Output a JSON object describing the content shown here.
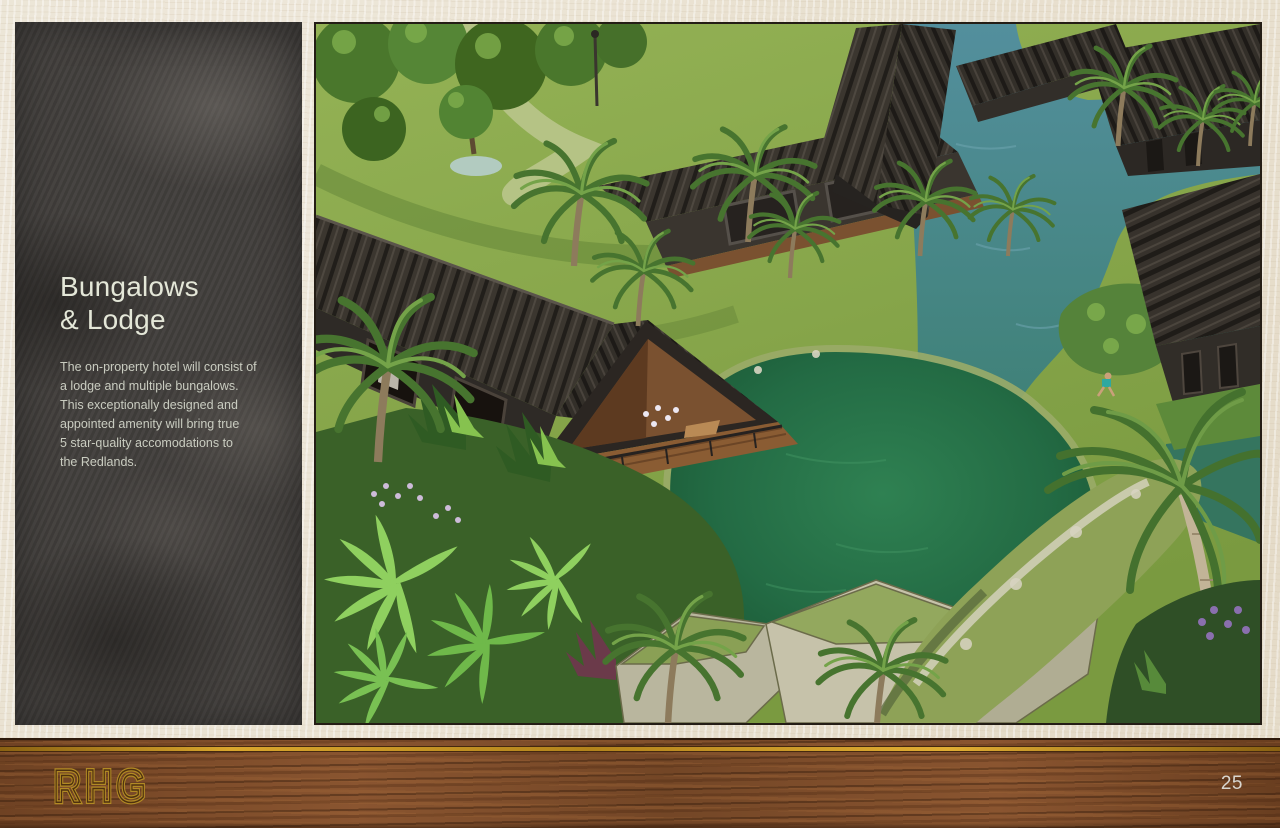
{
  "sidebar": {
    "title_lines": [
      "Bungalows",
      "& Lodge"
    ],
    "body_lines": [
      "The on-property hotel will consist of",
      "a lodge and multiple bungalows.",
      "This exceptionally designed and",
      "appointed amenity will bring true",
      "5 star-quality accomodations to",
      "the Redlands."
    ]
  },
  "image": {
    "description": "Aerial 3D rendering of dark-roofed bungalows and a lodge set among palm trees, a teal waterway, mossy rocks and an emerald lagoon"
  },
  "footer": {
    "logo": "RHG",
    "page_number": "25"
  },
  "colors": {
    "background": "#e9e1d0",
    "panel": "#43403d",
    "title_text": "#e4e7d8",
    "body_text": "#c9ccc0",
    "wood_bar": "#7b4b28",
    "gold_accent": "#c9941e",
    "page_number_text": "#d9d6cf"
  }
}
